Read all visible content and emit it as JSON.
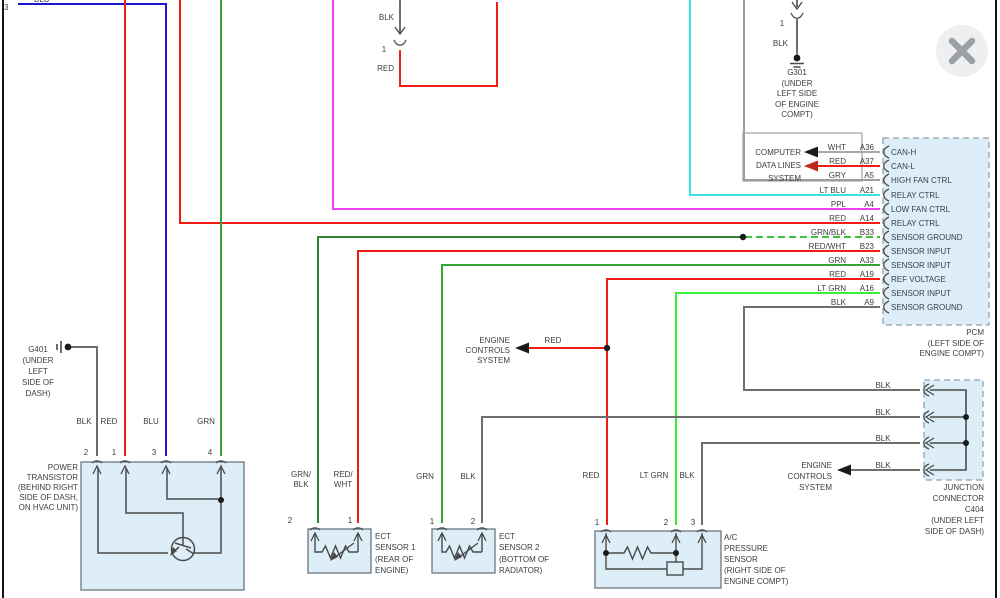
{
  "viewer": {
    "close_icon": "x"
  },
  "top": {
    "pin_3": "3",
    "blu": "BLU",
    "mid_blk": "BLK",
    "mid_pin": "1",
    "mid_red": "RED"
  },
  "g301": {
    "pin": "1",
    "wire": "BLK",
    "lines": [
      "G301",
      "(UNDER",
      "LEFT SIDE",
      "OF ENGINE",
      "COMPT)"
    ]
  },
  "computer_box": {
    "lines": [
      "COMPUTER",
      "DATA LINES",
      "SYSTEM"
    ]
  },
  "pcm": {
    "rows": [
      {
        "color": "WHT",
        "pin": "A36",
        "port": "CAN-H"
      },
      {
        "color": "RED",
        "pin": "A37",
        "port": "CAN-L"
      },
      {
        "color": "GRY",
        "pin": "A5",
        "port": "HIGH FAN CTRL"
      },
      {
        "color": "LT BLU",
        "pin": "A21",
        "port": "RELAY CTRL"
      },
      {
        "color": "PPL",
        "pin": "A4",
        "port": "LOW FAN CTRL"
      },
      {
        "color": "RED",
        "pin": "A14",
        "port": "RELAY CTRL"
      },
      {
        "color": "GRN/BLK",
        "pin": "B33",
        "port": "SENSOR GROUND"
      },
      {
        "color": "RED/WHT",
        "pin": "B23",
        "port": "SENSOR INPUT"
      },
      {
        "color": "GRN",
        "pin": "A33",
        "port": "SENSOR INPUT"
      },
      {
        "color": "RED",
        "pin": "A19",
        "port": "REF VOLTAGE"
      },
      {
        "color": "LT GRN",
        "pin": "A16",
        "port": "SENSOR INPUT"
      },
      {
        "color": "BLK",
        "pin": "A9",
        "port": "SENSOR GROUND"
      }
    ],
    "lines": [
      "PCM",
      "(LEFT SIDE OF",
      "ENGINE COMPT)"
    ]
  },
  "g401": {
    "lines": [
      "G401",
      "(UNDER",
      "LEFT",
      "SIDE OF",
      "DASH)"
    ]
  },
  "engine_controls_mid": {
    "lines": [
      "ENGINE",
      "CONTROLS",
      "SYSTEM"
    ],
    "wire": "RED"
  },
  "power_transistor": {
    "wires": [
      "BLK",
      "RED",
      "BLU",
      "GRN"
    ],
    "pins": [
      "2",
      "1",
      "3",
      "4"
    ],
    "lines": [
      "POWER",
      "TRANSISTOR",
      "(BEHIND RIGHT",
      "SIDE OF DASH,",
      "ON HVAC UNIT)"
    ]
  },
  "ect1": {
    "wire1": [
      "GRN/",
      "BLK"
    ],
    "wire2": [
      "RED/",
      "WHT"
    ],
    "pins": [
      "2",
      "1"
    ],
    "lines": [
      "ECT",
      "SENSOR 1",
      "(REAR OF",
      "ENGINE)"
    ]
  },
  "ect2": {
    "wires": [
      "GRN",
      "BLK"
    ],
    "pins": [
      "1",
      "2"
    ],
    "lines": [
      "ECT",
      "SENSOR 2",
      "(BOTTOM OF",
      "RADIATOR)"
    ]
  },
  "ac_sensor": {
    "wires": [
      "RED",
      "LT GRN",
      "BLK"
    ],
    "pins": [
      "1",
      "2",
      "3"
    ],
    "lines": [
      "A/C",
      "PRESSURE",
      "SENSOR",
      "(RIGHT SIDE OF",
      "ENGINE COMPT)"
    ]
  },
  "engine_controls_right": {
    "lines": [
      "ENGINE",
      "CONTROLS",
      "SYSTEM"
    ]
  },
  "junction": {
    "wire_labels": [
      "BLK",
      "BLK",
      "BLK",
      "BLK"
    ],
    "lines": [
      "JUNCTION",
      "CONNECTOR",
      "C404",
      "(UNDER LEFT",
      "SIDE OF DASH)"
    ]
  },
  "colors": {
    "red": "#ef1d14",
    "blue": "#2014cf",
    "green": "#35a435",
    "light_green": "#38ef38",
    "cyan": "#3fdfe8",
    "purple": "#ef3fef",
    "gray_wire": "#6e6e6e",
    "light_gray_wire": "#9d9d9d",
    "white_wire": "#a8a8a8",
    "dark_green": "#2f8032",
    "dash_green": "#3cc23c",
    "box_fill": "#ddeef9",
    "box_border": "#6b7780",
    "dashed_border": "#90a1ae",
    "symbol": "#4a4a4a",
    "black": "#1a1a1a",
    "arrow_red": "#c0251c"
  }
}
